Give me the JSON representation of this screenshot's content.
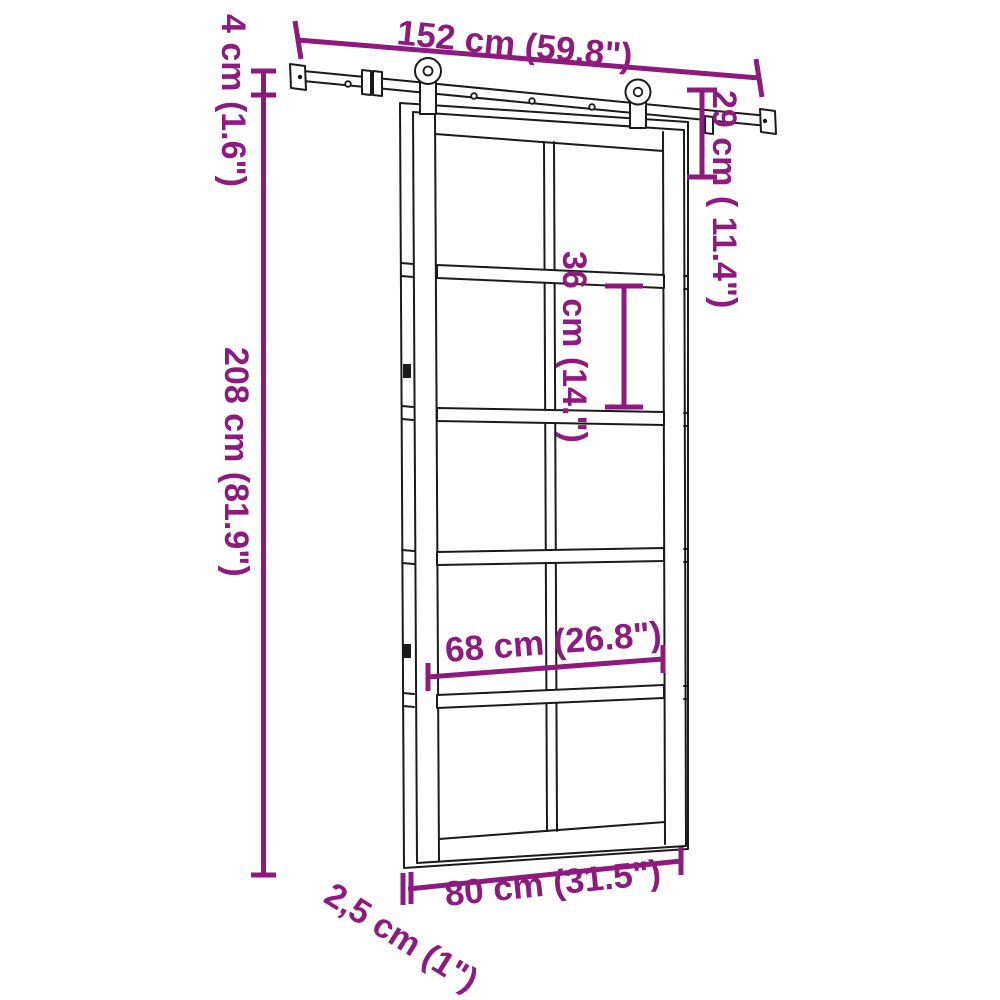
{
  "colors": {
    "accent": "#8F1A7E",
    "line": "#1a1a1a",
    "background": "#ffffff"
  },
  "diagram": {
    "subject": "sliding-door-with-hardware-kit-dimension-drawing",
    "view": "front perspective line drawing of a 10-pane sliding door hanging on a top track with two rollers",
    "labels": {
      "track_length": "152 cm (59.8\")",
      "track_drop": "4 cm (1.6\")",
      "door_height": "208 cm (81.9\")",
      "hanger_height": "29 cm ( 11.4\")",
      "pane_height": "36 cm (14.\")",
      "inner_width": "68 cm (26.8\")",
      "door_width": "80 cm (31.5\")",
      "door_thickness": "2,5 cm (1\")"
    }
  }
}
